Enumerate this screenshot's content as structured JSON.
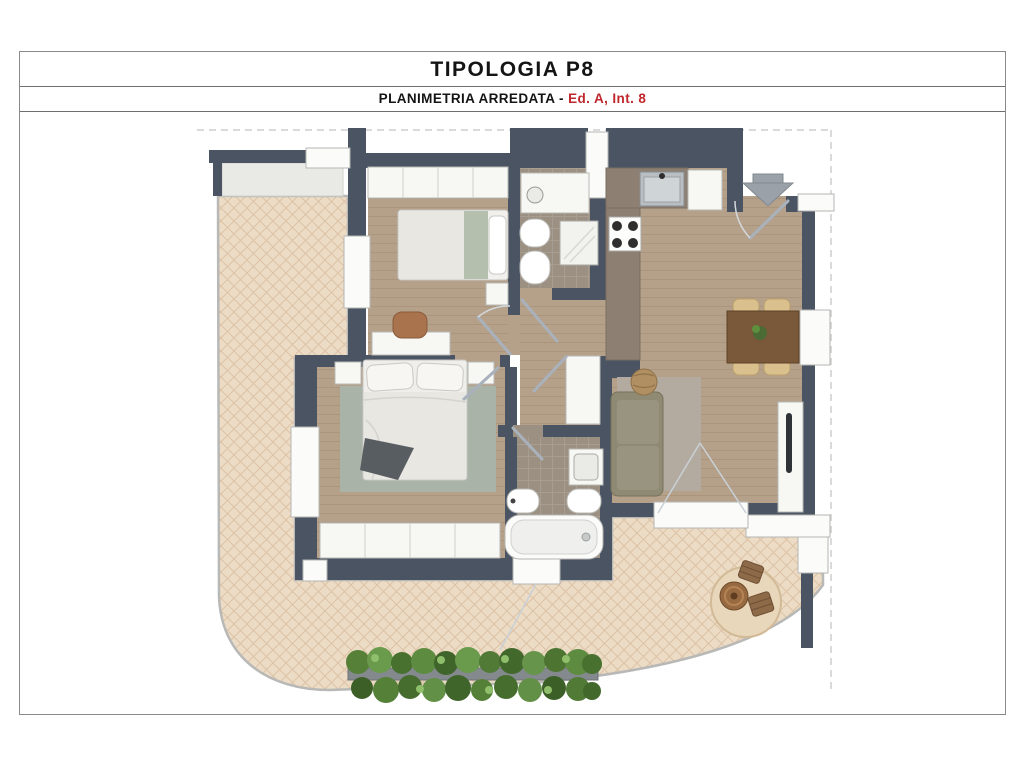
{
  "header": {
    "title": "TIPOLOGIA P8",
    "subtitle": {
      "prefix": "PLANIMETRIA ARREDATA - ",
      "highlight": "Ed. A, Int. 8"
    }
  },
  "palette": {
    "accent_red": "#c0272d",
    "wall": "#4a5462",
    "wood_floor": "#b5a18a",
    "terrace_tile": "#ecdcc5",
    "terrace_lattice": "#dcc2a6",
    "bath_tile": "#9c9082",
    "kitchen_counter": "#8d8073",
    "furniture_white": "#f7f7f4",
    "sofa_olive": "#8e8a74",
    "rug_sage": "#aab3a7",
    "rug_gray": "#b4aba0",
    "dining_wood": "#7a583a",
    "hedge_green": "#5d8c41",
    "arrow_gray": "#9aa1a8"
  },
  "plan": {
    "type": "apartment-floor-plan",
    "entrance_marker": "down-arrow",
    "rooms": [
      "terrace",
      "bedroom-1",
      "bathroom-1",
      "kitchen",
      "living-dining",
      "hallway",
      "master-bedroom",
      "bathroom-2"
    ],
    "furnishings": [
      "single-bed",
      "desk",
      "desk-chair",
      "wardrobe",
      "vanity-basin",
      "bidet",
      "toilet",
      "shower",
      "kitchen-counter",
      "sink",
      "stove",
      "tall-cabinet",
      "dining-table",
      "dining-chairs",
      "sofa",
      "pouf",
      "area-rug",
      "tv-sideboard",
      "double-bed",
      "nightstands",
      "bedroom-rug",
      "master-wardrobe",
      "washbasin",
      "bathtub",
      "outdoor-table",
      "outdoor-stools",
      "round-mat",
      "hedge-planter"
    ]
  }
}
